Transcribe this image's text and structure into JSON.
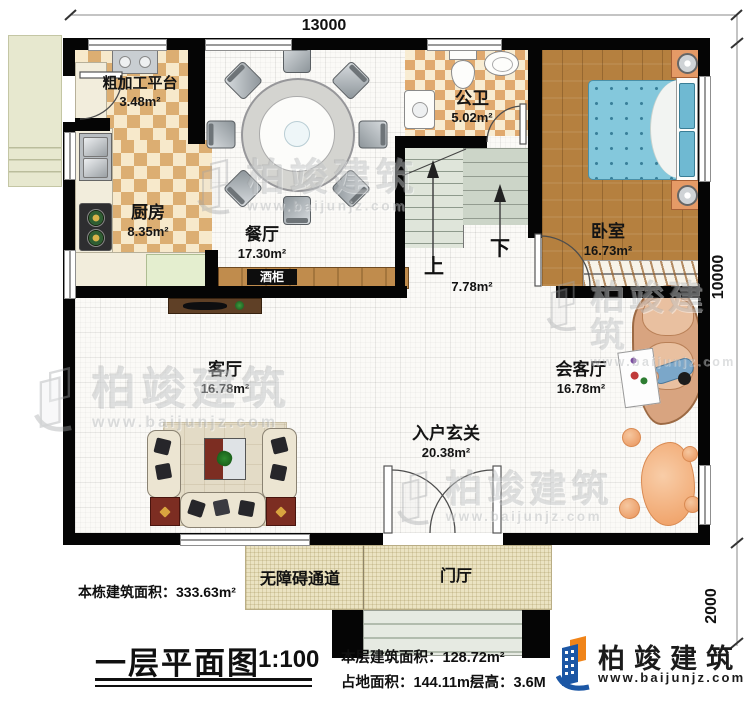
{
  "dimensions": {
    "top": "13000",
    "right_main": "10000",
    "right_porch": "2000"
  },
  "rooms": {
    "prep": {
      "name": "粗加工平台",
      "area": "3.48m²"
    },
    "kitchen": {
      "name": "厨房",
      "area": "8.35m²"
    },
    "dining": {
      "name": "餐厅",
      "area": "17.30m²"
    },
    "bath": {
      "name": "公卫",
      "area": "5.02m²"
    },
    "bedroom": {
      "name": "卧室",
      "area": "16.73m²"
    },
    "living": {
      "name": "客厅",
      "area": "16.78m²"
    },
    "reception": {
      "name": "会客厅",
      "area": "16.78m²"
    },
    "foyer": {
      "name": "入户玄关",
      "area": "20.38m²"
    },
    "stairs": {
      "area": "7.78m²",
      "up_label": "上",
      "down_label": "下"
    },
    "wine_cabinet": {
      "name": "酒柜"
    },
    "ramp": {
      "name": "无障碍通道"
    },
    "porch": {
      "name": "门厅"
    }
  },
  "footer": {
    "building_total_area": "本栋建筑面积：333.63m²",
    "title": "一层平面图",
    "scale": "1:100",
    "floor_area": "本层建筑面积：128.72m²",
    "land_area": "占地面积：144.11m²",
    "floor_height": "层高：3.6M"
  },
  "brand": {
    "name": "柏竣建筑",
    "url": "www.baijunjz.com"
  },
  "watermark": {
    "name": "柏竣建筑",
    "url": "www.baijunjz.com"
  }
}
